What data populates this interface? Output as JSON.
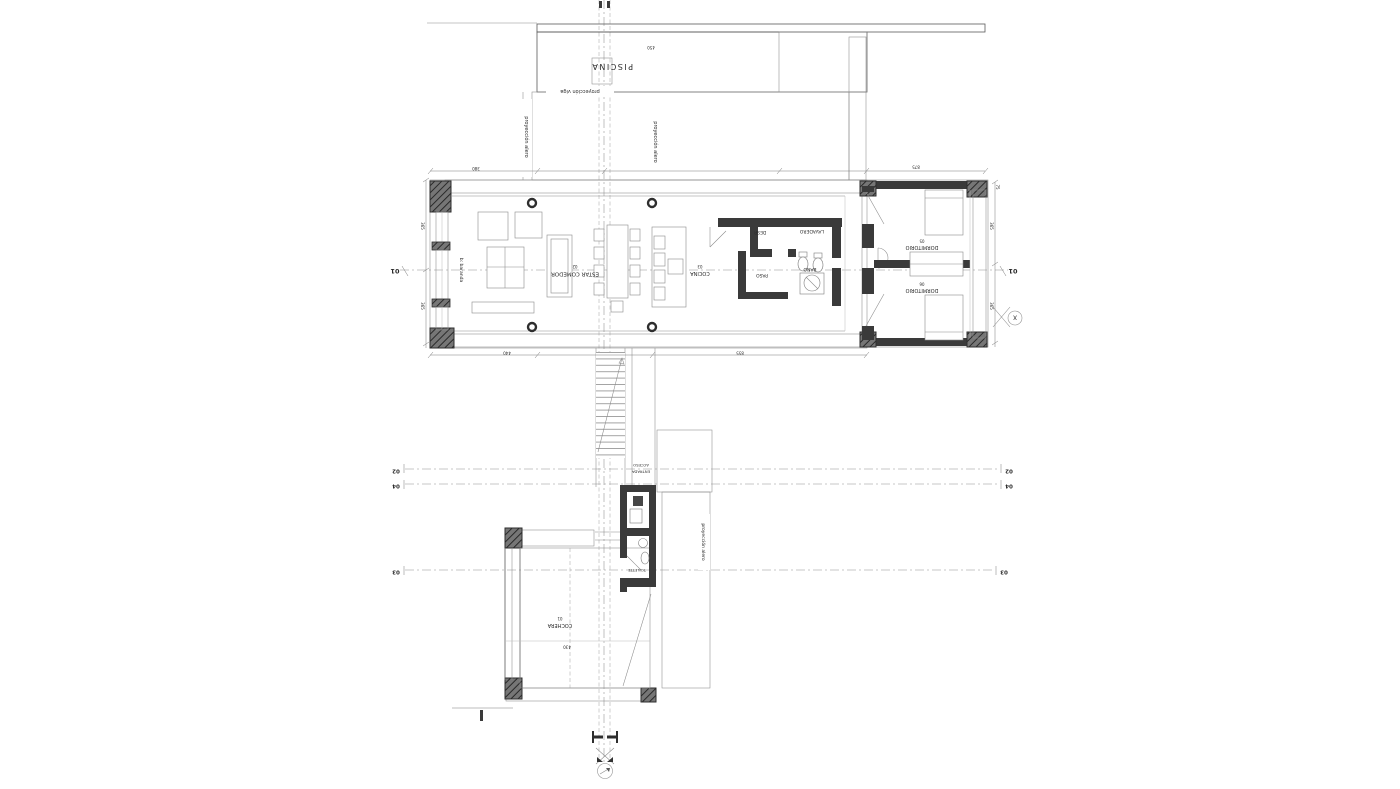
{
  "labels": {
    "pool": "PISCINA",
    "beam_projection": "proyección viga",
    "eave_left": "proyección alero",
    "eave_mid": "proyección alero",
    "eave_stair": "proyección alero",
    "gallery_edge": "b: baranda",
    "access_1": "ACCESO",
    "access_2": "ENTRADA"
  },
  "rooms": {
    "living_num": "02",
    "living": "ESTAR COMEDOR",
    "kitchen_num": "03",
    "kitchen": "COCINA",
    "paso": "PASO",
    "desp": "DESP.",
    "lavadero": "LAVADERO",
    "bano": "BAÑO",
    "dorm1_num": "05",
    "dorm1": "DORMITORIO",
    "dorm2_num": "06",
    "dorm2": "DORMITORIO",
    "garage_num": "01",
    "garage": "COCHERA",
    "toilette": "TOILETTE"
  },
  "markers": {
    "s01": "01",
    "s02": "02",
    "s03": "03",
    "s04": "04",
    "x": "X"
  },
  "dims": {
    "d0": "450",
    "d1": "380",
    "d2": "875",
    "d3": "440",
    "d4": "855",
    "d5": "365",
    "d6": "365",
    "d7": "365",
    "d8": "365",
    "d9": "430",
    "d10": "75"
  }
}
